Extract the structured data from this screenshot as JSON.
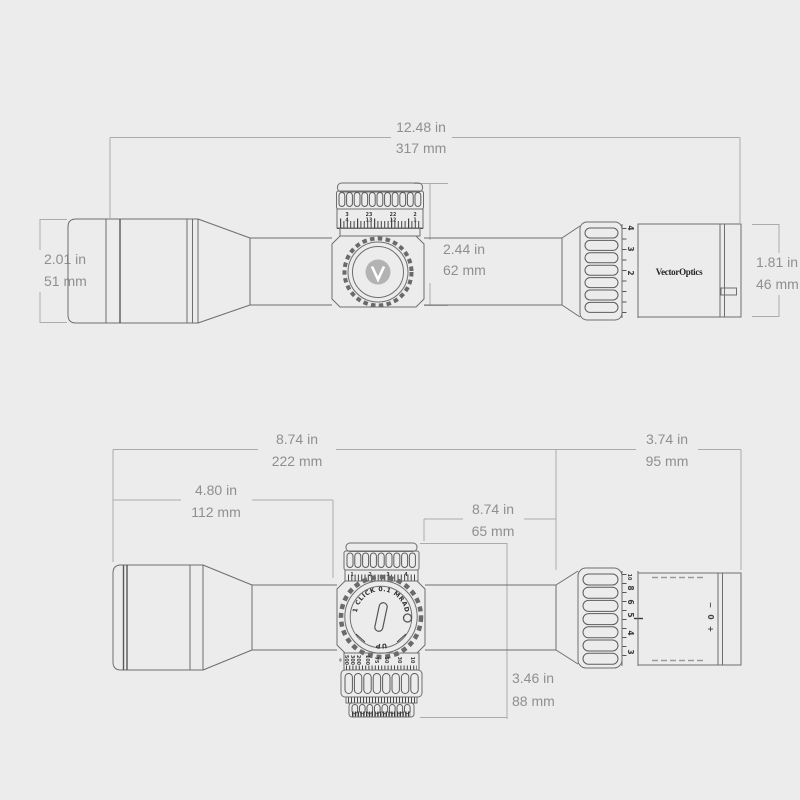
{
  "colors": {
    "background": "#ececec",
    "drawing_line": "#6e6e6e",
    "dimension_line": "#ababab",
    "dimension_text": "#8f8f8f",
    "detail_dark": "#3a3a3a"
  },
  "top_view": {
    "dims": {
      "total": {
        "in": "12.48 in",
        "mm": "317 mm"
      },
      "turret_height": {
        "in": "2.44 in",
        "mm": "62 mm"
      },
      "objective": {
        "in": "2.01 in",
        "mm": "51 mm"
      },
      "eyepiece": {
        "in": "1.81 in",
        "mm": "46 mm"
      }
    },
    "logo": "VectorOptics",
    "mag_labels": [
      "4",
      "3",
      "2"
    ],
    "turret_labels_upper": [
      "3",
      "23",
      "22",
      "2"
    ],
    "turret_labels_lower": [
      "4",
      "13",
      "12",
      "1"
    ]
  },
  "bottom_view": {
    "dims": {
      "front_section": {
        "in": "8.74 in",
        "mm": "222 mm"
      },
      "eyepiece_section": {
        "in": "3.74 in",
        "mm": "95 mm"
      },
      "objective_section": {
        "in": "4.80 in",
        "mm": "112 mm"
      },
      "saddle_section": {
        "in": "8.74 in",
        "mm": "65 mm"
      },
      "turret_span": {
        "in": "3.46 in",
        "mm": "88 mm"
      }
    },
    "turret": {
      "click_label": "1 CLICK 0.1 MRAD",
      "up_label": "UP"
    },
    "windage_labels": [
      "1",
      "2",
      "3",
      "4"
    ],
    "parallax_labels": [
      "∞",
      "500",
      "300",
      "200",
      "100",
      "75",
      "50",
      "30",
      "10"
    ],
    "mag_labels": [
      "10",
      "8",
      "6",
      "5",
      "4",
      "3"
    ],
    "diopter_labels": [
      "−",
      "0",
      "+"
    ]
  }
}
